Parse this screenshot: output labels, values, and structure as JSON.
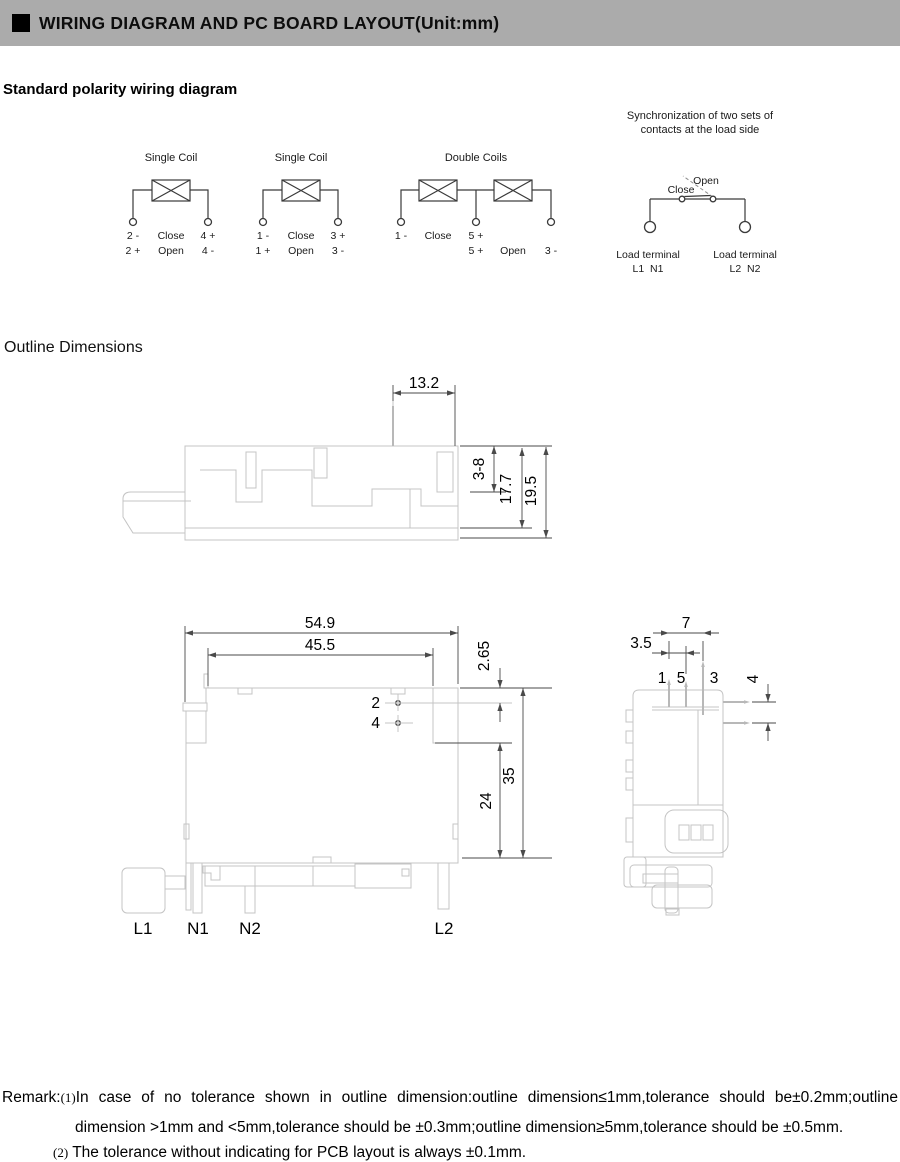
{
  "header": {
    "title": "WIRING DIAGRAM AND PC BOARD LAYOUT(Unit:mm)"
  },
  "headings": {
    "wiring": "Standard polarity wiring diagram",
    "outline": "Outline Dimensions"
  },
  "colors": {
    "header_bg": "#ababab",
    "part_line": "#c4c4c4",
    "diagram_line": "#3a3a3a"
  },
  "wiring": {
    "diagram1": {
      "title": "Single Coil",
      "close_row": [
        "2 -",
        "Close",
        "4 +"
      ],
      "open_row": [
        "2 +",
        "Open",
        "4 -"
      ]
    },
    "diagram2": {
      "title": "Single Coil",
      "close_row": [
        "1 -",
        "Close",
        "3 +"
      ],
      "open_row": [
        "1 +",
        "Open",
        "3 -"
      ]
    },
    "diagram3": {
      "title": "Double Coils",
      "close_row": [
        "1 -",
        "Close",
        "5 +"
      ],
      "open_row": [
        "5 +",
        "Open",
        "3 -"
      ]
    },
    "diagram4": {
      "title_line1": "Synchronization of two sets of",
      "title_line2": "contacts at the load side",
      "open_label": "Open",
      "close_label": "Close",
      "left_terminal_label": "Load terminal",
      "left_terminal_ids": "L1  N1",
      "right_terminal_label": "Load terminal",
      "right_terminal_ids": "L2  N2"
    }
  },
  "outline": {
    "top_view": {
      "dim_pin_offset": "13.2",
      "dim_panel_range": "3-8",
      "dim_body_height": "17.7",
      "dim_total_height": "19.5"
    },
    "front_view": {
      "dim_total_width": "54.9",
      "dim_inner_width": "45.5",
      "dim_pin_inset": "2.65",
      "dim_lower_height": "24",
      "dim_total_height": "35",
      "pin2_label": "2",
      "pin4_label": "4",
      "terminals": [
        "L1",
        "N1",
        "N2",
        "L2"
      ]
    },
    "side_view": {
      "dim_pin_span": "7",
      "dim_pin_pitch": "3.5",
      "dim_side_pin_gap": "4",
      "pin_labels": [
        "1",
        "5",
        "3"
      ]
    }
  },
  "remark": {
    "prefix": "Remark:",
    "note1_marker": "(1)",
    "note1_line1": "In case of no tolerance shown in outline dimension:outline dimension≤1mm,tolerance should be±0.2mm;outline",
    "note1_line2": "dimension >1mm and <5mm,tolerance should be ±0.3mm;outline dimension≥5mm,tolerance should be ±0.5mm.",
    "note2_marker": "(2)",
    "note2_text": "The tolerance without indicating for PCB layout is always ±0.1mm."
  }
}
